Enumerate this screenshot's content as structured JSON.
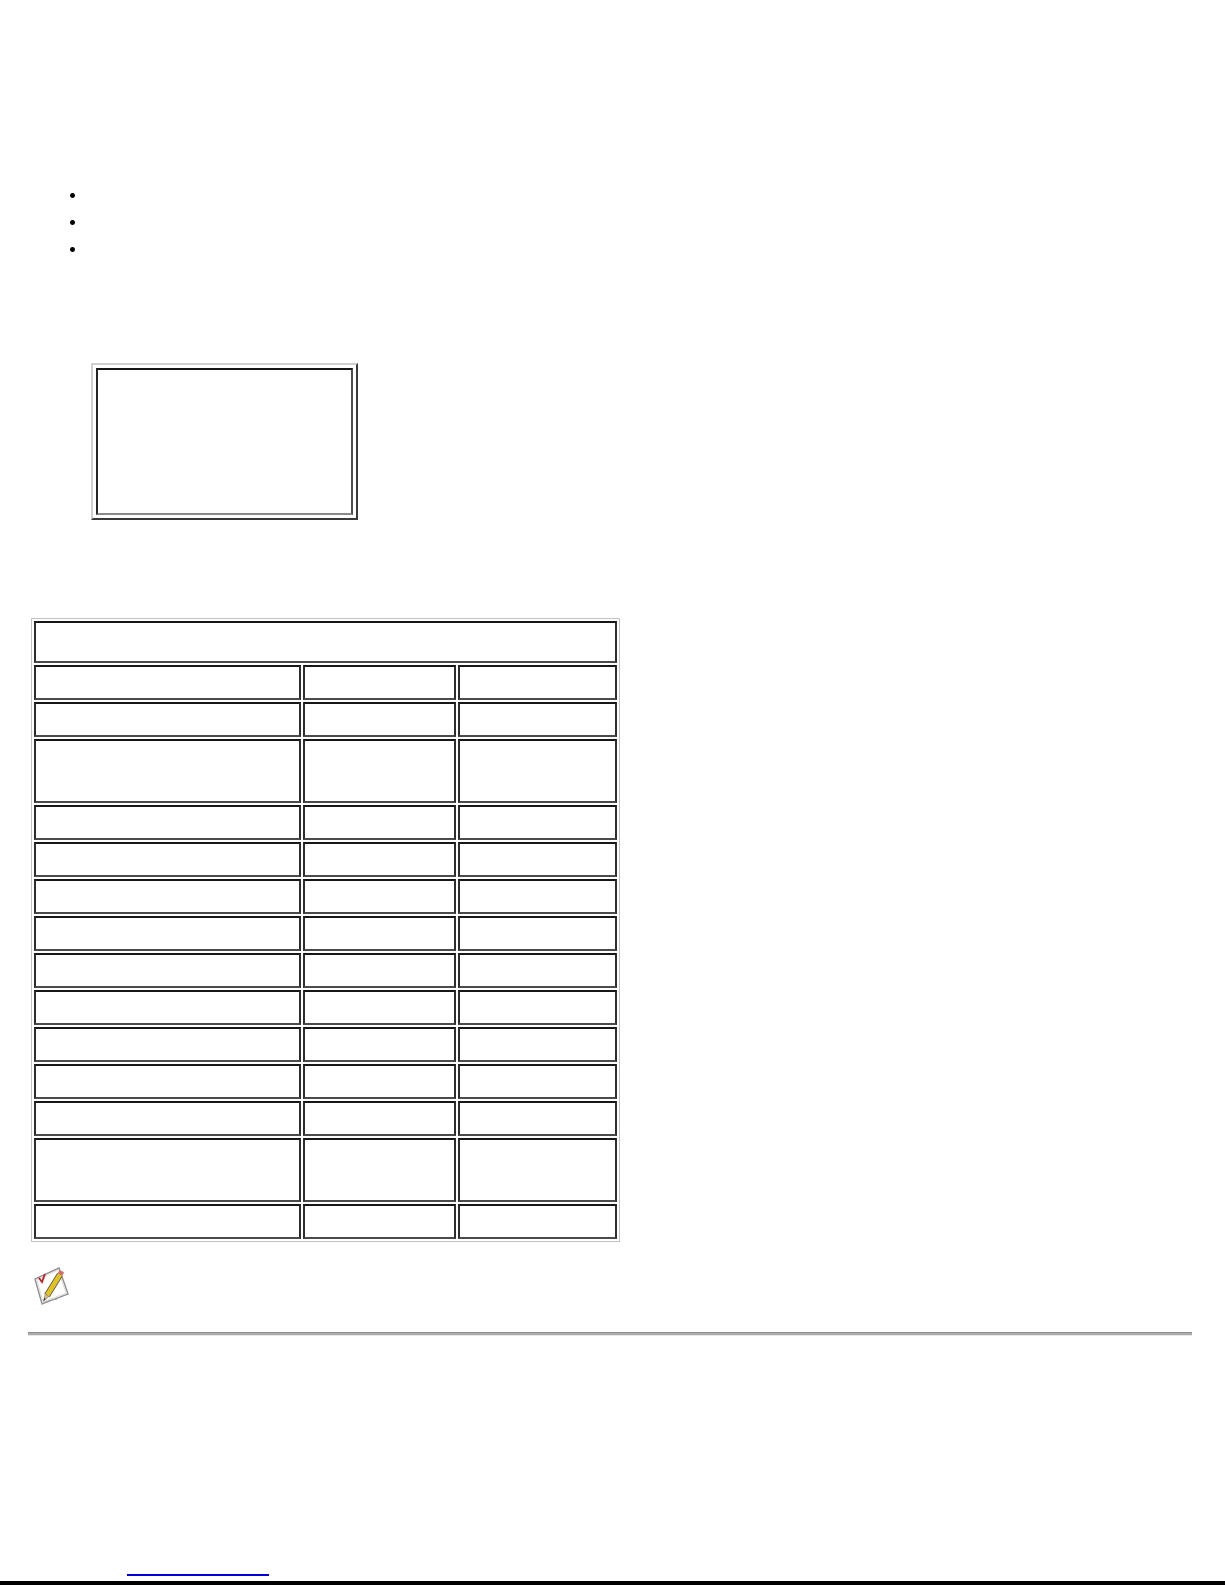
{
  "page": {
    "background": "#ffffff"
  },
  "intro_list": {
    "items": [
      "",
      "",
      ""
    ]
  },
  "image_placeholder": {
    "content": ""
  },
  "spec_table": {
    "header": {
      "colspan": 3,
      "cells": [
        ""
      ]
    },
    "rows": [
      {
        "cells": [
          "",
          "",
          ""
        ]
      },
      {
        "cells": [
          "",
          "",
          ""
        ]
      },
      {
        "cells": [
          "",
          "",
          ""
        ],
        "tall": true
      },
      {
        "cells": [
          "",
          "",
          ""
        ]
      },
      {
        "cells": [
          "",
          "",
          ""
        ]
      },
      {
        "cells": [
          "",
          "",
          ""
        ]
      },
      {
        "cells": [
          "",
          "",
          ""
        ]
      },
      {
        "cells": [
          "",
          "",
          ""
        ]
      },
      {
        "cells": [
          "",
          "",
          ""
        ]
      },
      {
        "cells": [
          "",
          "",
          ""
        ]
      },
      {
        "cells": [
          "",
          "",
          ""
        ]
      },
      {
        "cells": [
          "",
          "",
          ""
        ]
      },
      {
        "cells": [
          "",
          "",
          ""
        ],
        "tall": true
      },
      {
        "cells": [
          "",
          "",
          ""
        ]
      }
    ]
  },
  "note": {
    "icon": "note-pencil-icon",
    "text": ""
  },
  "footer": {
    "link_label": "",
    "link_color": "#0000dd"
  },
  "bottom_bar": {
    "color": "#000000"
  }
}
